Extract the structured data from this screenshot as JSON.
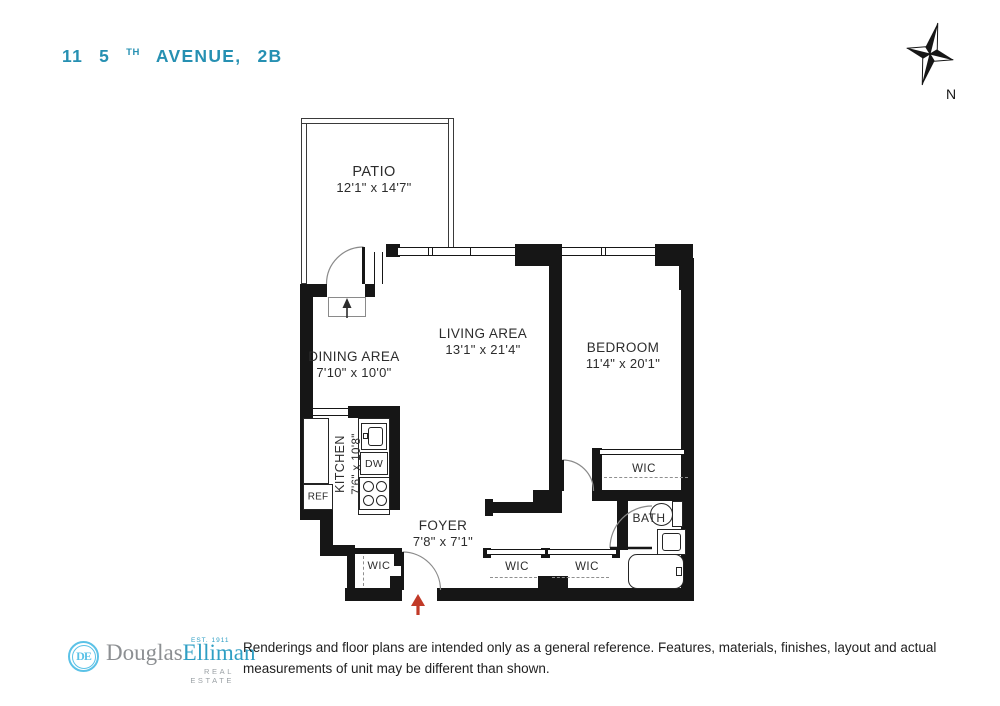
{
  "title": {
    "building_number": "11",
    "street_number": "5",
    "street_ordinal": "TH",
    "street_name": "AVENUE,",
    "unit": "2B"
  },
  "compass": {
    "north_label": "N"
  },
  "rooms": {
    "patio": {
      "name": "PATIO",
      "dimensions": "12'1\" x 14'7\""
    },
    "dining_area": {
      "name": "DINING AREA",
      "dimensions": "7'10\" x 10'0\""
    },
    "living_area": {
      "name": "LIVING AREA",
      "dimensions": "13'1\" x 21'4\""
    },
    "bedroom": {
      "name": "BEDROOM",
      "dimensions": "11'4\" x 20'1\""
    },
    "kitchen": {
      "name": "KITCHEN",
      "dimensions": "7'6\" x 10'8\""
    },
    "foyer": {
      "name": "FOYER",
      "dimensions": "7'8\" x 7'1\""
    },
    "bath": {
      "name": "BATH"
    }
  },
  "closets": {
    "foyer_wic": "WIC",
    "hall_wic_1": "WIC",
    "hall_wic_2": "WIC",
    "bedroom_wic": "WIC"
  },
  "appliances": {
    "refrigerator": "REF",
    "dishwasher": "DW"
  },
  "footer": {
    "brand": {
      "monogram": "DE",
      "name_part_1": "Douglas",
      "name_part_2": "Elliman",
      "established": "EST. 1911",
      "tagline": "REAL ESTATE"
    },
    "disclaimer": "Renderings and floor plans are intended only as a general reference. Features, materials, finishes, layout and actual measurements of unit may be different than shown."
  },
  "colors": {
    "accent_teal": "#2690b2",
    "logo_blue": "#5bc2e7",
    "logo_gray": "#8c8f92",
    "wall_black": "#161616",
    "arrow_red": "#c13a28"
  }
}
